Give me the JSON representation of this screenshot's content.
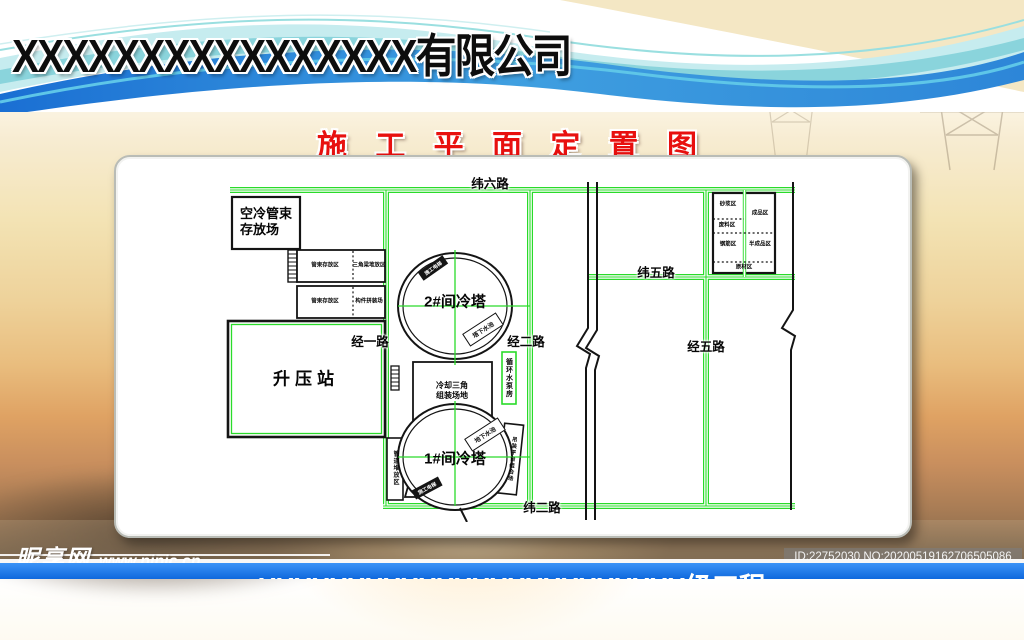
{
  "header": {
    "company_name": "XXXXXXXXXXXXXXXX有限公司"
  },
  "page_title": "施 工 平 面 定 置 图",
  "plan": {
    "roads": {
      "wei6": "纬六路",
      "wei5": "纬五路",
      "wei2": "纬二路",
      "jing1": "经一路",
      "jing2": "经二路",
      "jing5": "经五路"
    },
    "areas": {
      "air_cooling_storage": "空冷管束\n存放场",
      "tube_zone_top": "管束存放区",
      "triangle_zone": "三角梁堆放区",
      "tube_zone_bottom": "管束存放区",
      "component_zone": "构件拼装场",
      "booster_station": "升压站",
      "tower2": "2#间冷塔",
      "tower1": "1#间冷塔",
      "cooling_triangle": "冷却三角\n组装场地",
      "pump_house": "循环水泵房",
      "pipe_storage": "管道堆放区",
      "hoist_platform": "吊装平台组合场",
      "pool_tower2": "塔下水池",
      "pool_tower1": "地下水池",
      "elevator_tower2": "施工电梯",
      "elevator_tower1": "施工电梯"
    },
    "rebar_yard": {
      "zone1": "砂浆区",
      "zone2": "成品区",
      "zone3": "废料区",
      "zone4": "钢筋区",
      "zone5": "半成品区",
      "zone6": "原材区"
    }
  },
  "watermark": {
    "site_name": "昵享网",
    "site_url": "www.nipic.cn"
  },
  "footer": {
    "id_text": "ID:22752030 NO:20200519162706505086",
    "banner_text": "XXXXXXXXXXXXXXXXXXXXXXXX级工程"
  }
}
